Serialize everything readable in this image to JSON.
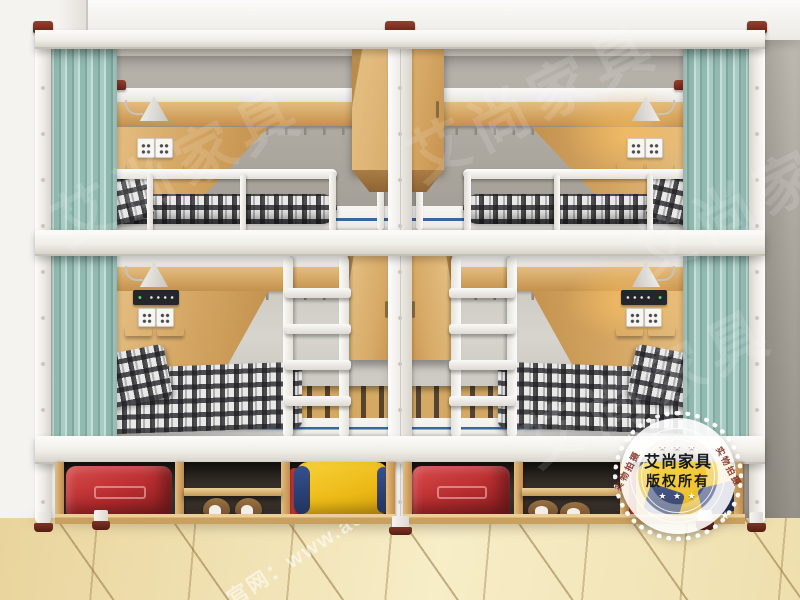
{
  "watermarks": {
    "brand": "艾尚家具",
    "website": "官网：www.a50",
    "website_fragment": "com"
  },
  "badge": {
    "brand": "艾尚家具",
    "copyright": "版权所有",
    "ring_label": "实物拍摄",
    "stars": "★ ★ ★"
  },
  "scene": {
    "description": "3D render of two white-steel capsule dormitory bunk-bed units (four berths) with teal privacy curtains, oak headboard panels with wall lamps, power outlets and USB charging panels, coat-hook rails, white ladders, hanging oak cabinets, and under-bed open storage holding red suitcases, shoes and yellow duffel bags, on a beige tiled floor",
    "colors": {
      "frame_white": "#f2f0ec",
      "post_cap_maroon": "#7c2d20",
      "curtain_teal": "#a3c8bf",
      "oak_wood": "#d5a763",
      "upper_panel_gray": "#a8a39b",
      "lower_panel_gray": "#cfccc6",
      "wall": "#b1aca3",
      "floor": "#eedcaa",
      "bedding_plaid_dark": "#3c3c3e",
      "pillow_mustard": "#d79a2e",
      "mattress_stripe_blue": "#3a66a0",
      "suitcase_red": "#c23434",
      "bag_yellow": "#f0c11f",
      "bag_navy": "#27355f"
    }
  }
}
